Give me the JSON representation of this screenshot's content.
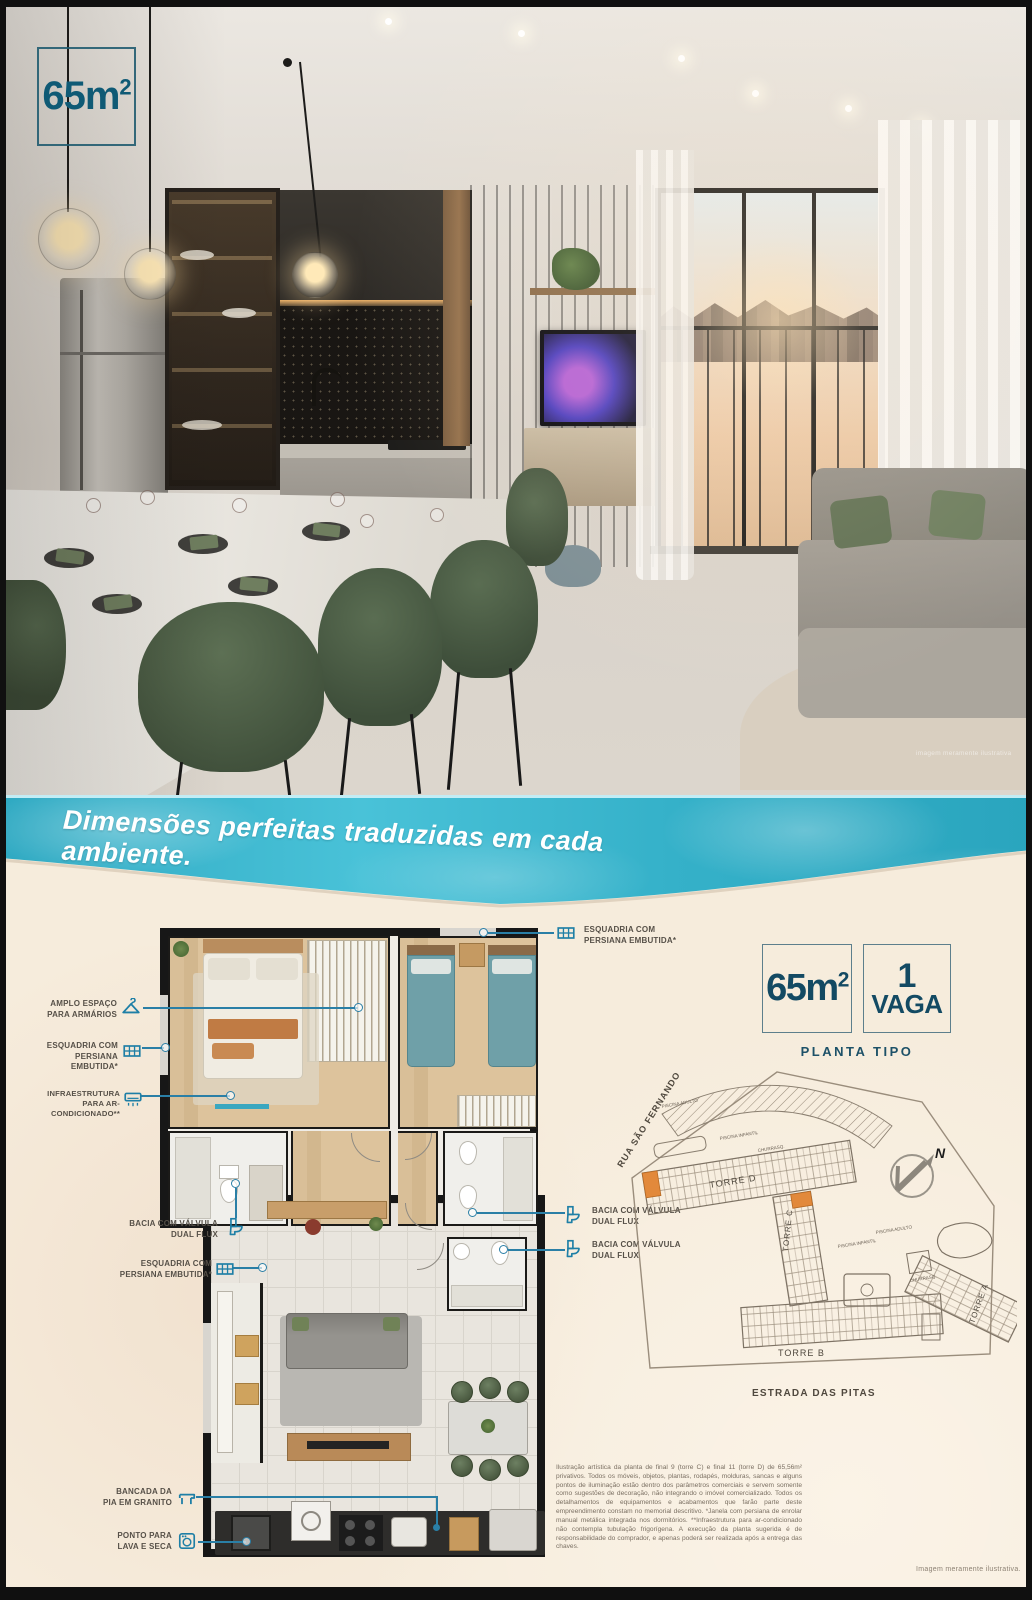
{
  "hero": {
    "area_value": "65m",
    "area_sup": "2",
    "disclaimer": "imagem meramente ilustrativa"
  },
  "banner": {
    "headline": "Dimensões perfeitas traduzidas em cada ambiente."
  },
  "annotations": {
    "left": [
      {
        "icon": "hanger-icon",
        "line1": "AMPLO ESPAÇO",
        "line2": "PARA ARMÁRIOS"
      },
      {
        "icon": "window-icon",
        "line1": "ESQUADRIA COM",
        "line2": "PERSIANA EMBUTIDA*"
      },
      {
        "icon": "ac-icon",
        "line1": "INFRAESTRUTURA",
        "line2": "PARA AR-CONDICIONADO**"
      },
      {
        "icon": "toilet-icon",
        "line1": "BACIA COM VÁLVULA",
        "line2": "DUAL FLUX"
      },
      {
        "icon": "window-icon",
        "line1": "ESQUADRIA COM",
        "line2": "PERSIANA EMBUTIDA*"
      },
      {
        "icon": "counter-icon",
        "line1": "BANCADA DA",
        "line2": "PIA EM GRANITO"
      },
      {
        "icon": "washer-icon",
        "line1": "PONTO PARA",
        "line2": "LAVA E SECA"
      }
    ],
    "right": [
      {
        "icon": "window-icon",
        "line1": "ESQUADRIA COM",
        "line2": "PERSIANA EMBUTIDA*"
      },
      {
        "icon": "toilet-icon",
        "line1": "BACIA COM VÁLVULA",
        "line2": "DUAL FLUX"
      },
      {
        "icon": "toilet-icon",
        "line1": "BACIA COM VÁLVULA",
        "line2": "DUAL FLUX"
      }
    ]
  },
  "badges": {
    "area_value": "65m",
    "area_sup": "2",
    "vaga_number": "1",
    "vaga_label": "VAGA",
    "caption": "PLANTA TIPO"
  },
  "siteplan": {
    "street_left": "RUA SÃO FERNANDO",
    "street_bottom": "ESTRADA DAS PITAS",
    "torre_a": "TORRE A",
    "torre_b": "TORRE B",
    "torre_c": "TORRE C",
    "torre_d": "TORRE D",
    "pool_adult_top": "PISCINA ADULTO",
    "pool_kids_top": "PISCINA INFANTIL",
    "bbq_top": "CHURRASQ.",
    "pool_adult_right": "PISCINA ADULTO",
    "pool_kids_right": "PISCINA INFANTIL",
    "bbq_right": "CHURRASQ.",
    "compass_n": "N"
  },
  "legal": {
    "text": "Ilustração artística da planta de final 9 (torre C) e final 11 (torre D) de 65,56m² privativos. Todos os móveis, objetos, plantas, rodapés, molduras, sancas e alguns pontos de iluminação estão dentro dos parâmetros comerciais e servem somente como sugestões de decoração, não integrando o imóvel comercializado. Todos os detalhamentos de equipamentos e acabamentos que farão parte deste empreendimento constam no memorial descritivo. *Janela com persiana de enrolar manual metálica integrada nos dormitórios. **Infraestrutura para ar-condicionado não contempla tubulação frigorígena. A execução da planta sugerida é de responsabilidade do comprador, e apenas poderá ser realizada após a entrega das chaves.",
    "disclaimer": "Imagem meramente ilustrativa."
  },
  "colors": {
    "teal_accent": "#2a7fa6",
    "banner_turquoise": "#3ab5cd",
    "badge_text": "#134a63",
    "sand": "#f6ecdc"
  }
}
